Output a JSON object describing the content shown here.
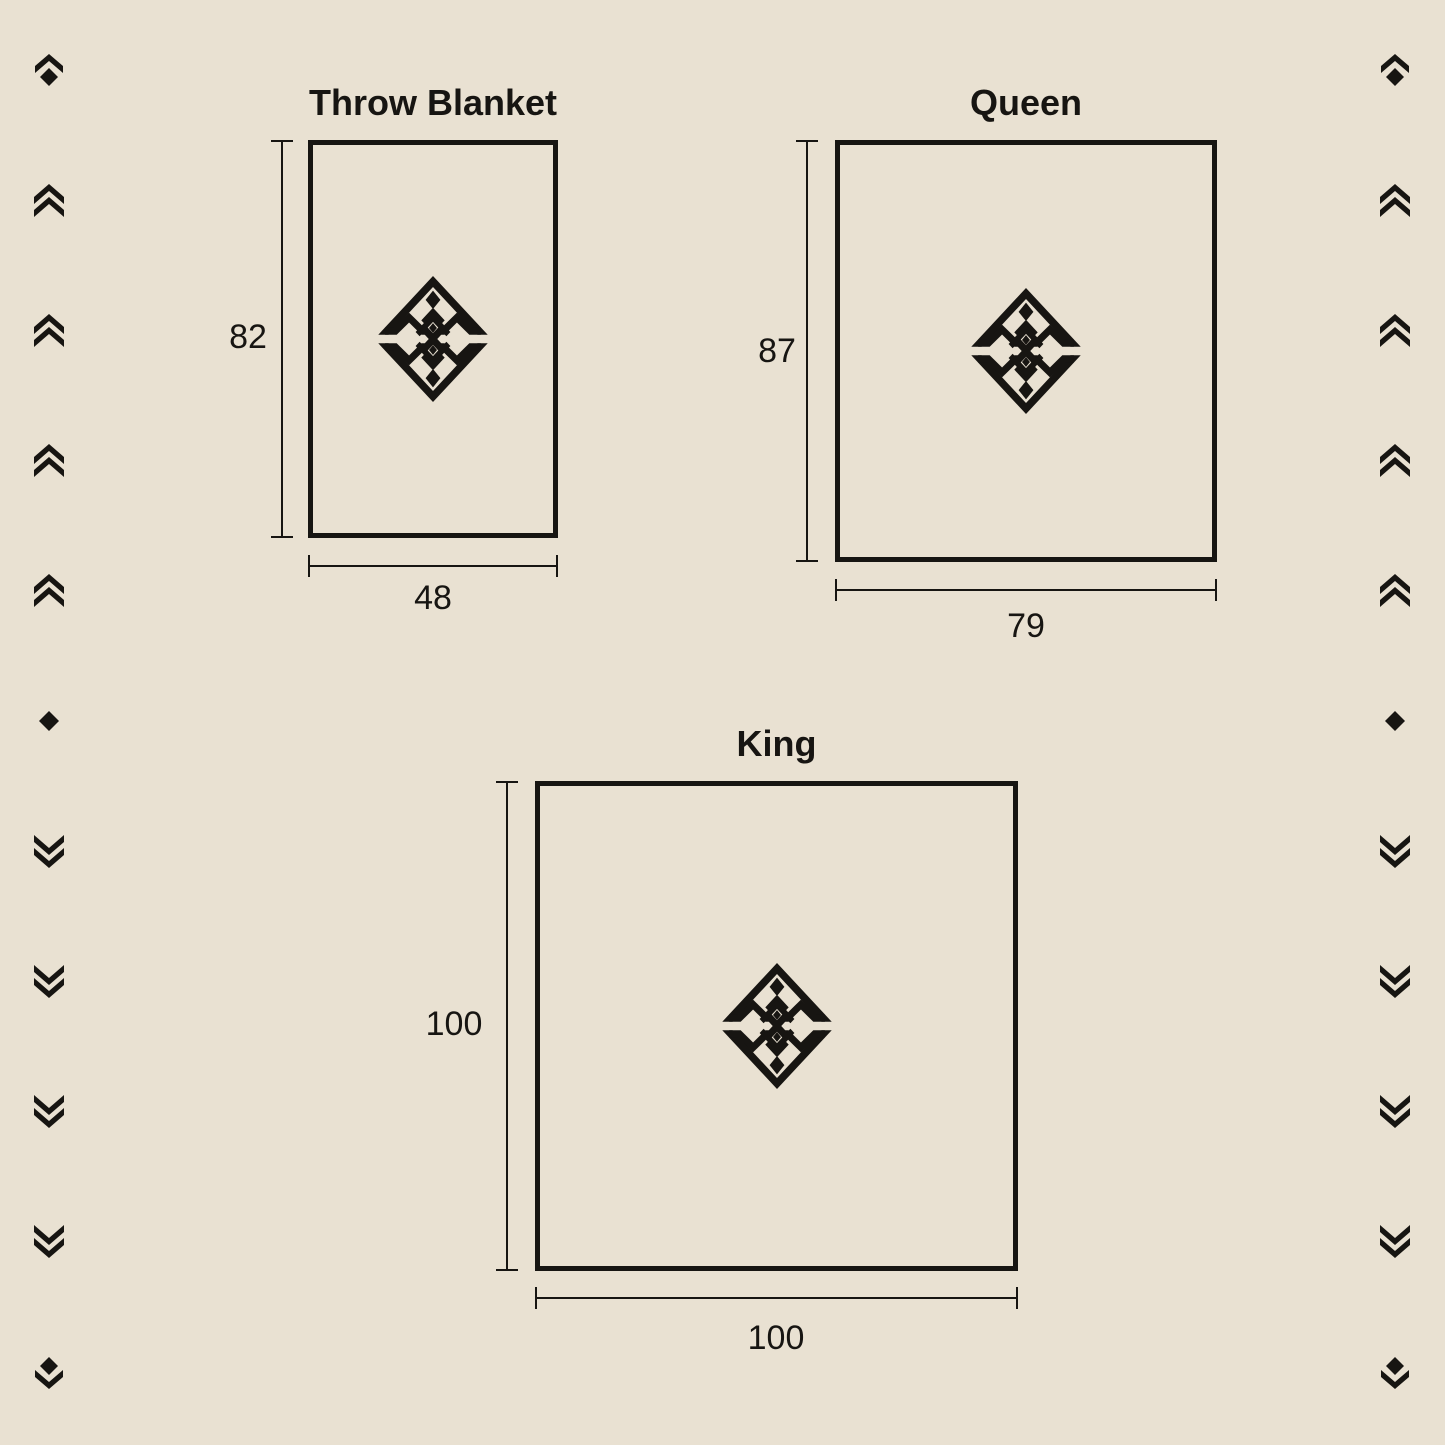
{
  "colors": {
    "background": "#e9e1d2",
    "ink": "#171512"
  },
  "diagrams": [
    {
      "name": "Throw Blanket",
      "height": "82",
      "width": "48"
    },
    {
      "name": "Queen",
      "height": "87",
      "width": "79"
    },
    {
      "name": "King",
      "height": "100",
      "width": "100"
    }
  ],
  "logo": {
    "name": "brand-diamond-logo"
  },
  "ornaments": {
    "sequence": [
      "chevron-up-diamond",
      "double-chevron-up",
      "double-chevron-up",
      "double-chevron-up",
      "double-chevron-up",
      "diamond",
      "double-chevron-down",
      "double-chevron-down",
      "double-chevron-down",
      "double-chevron-down",
      "diamond-chevron-down"
    ]
  }
}
